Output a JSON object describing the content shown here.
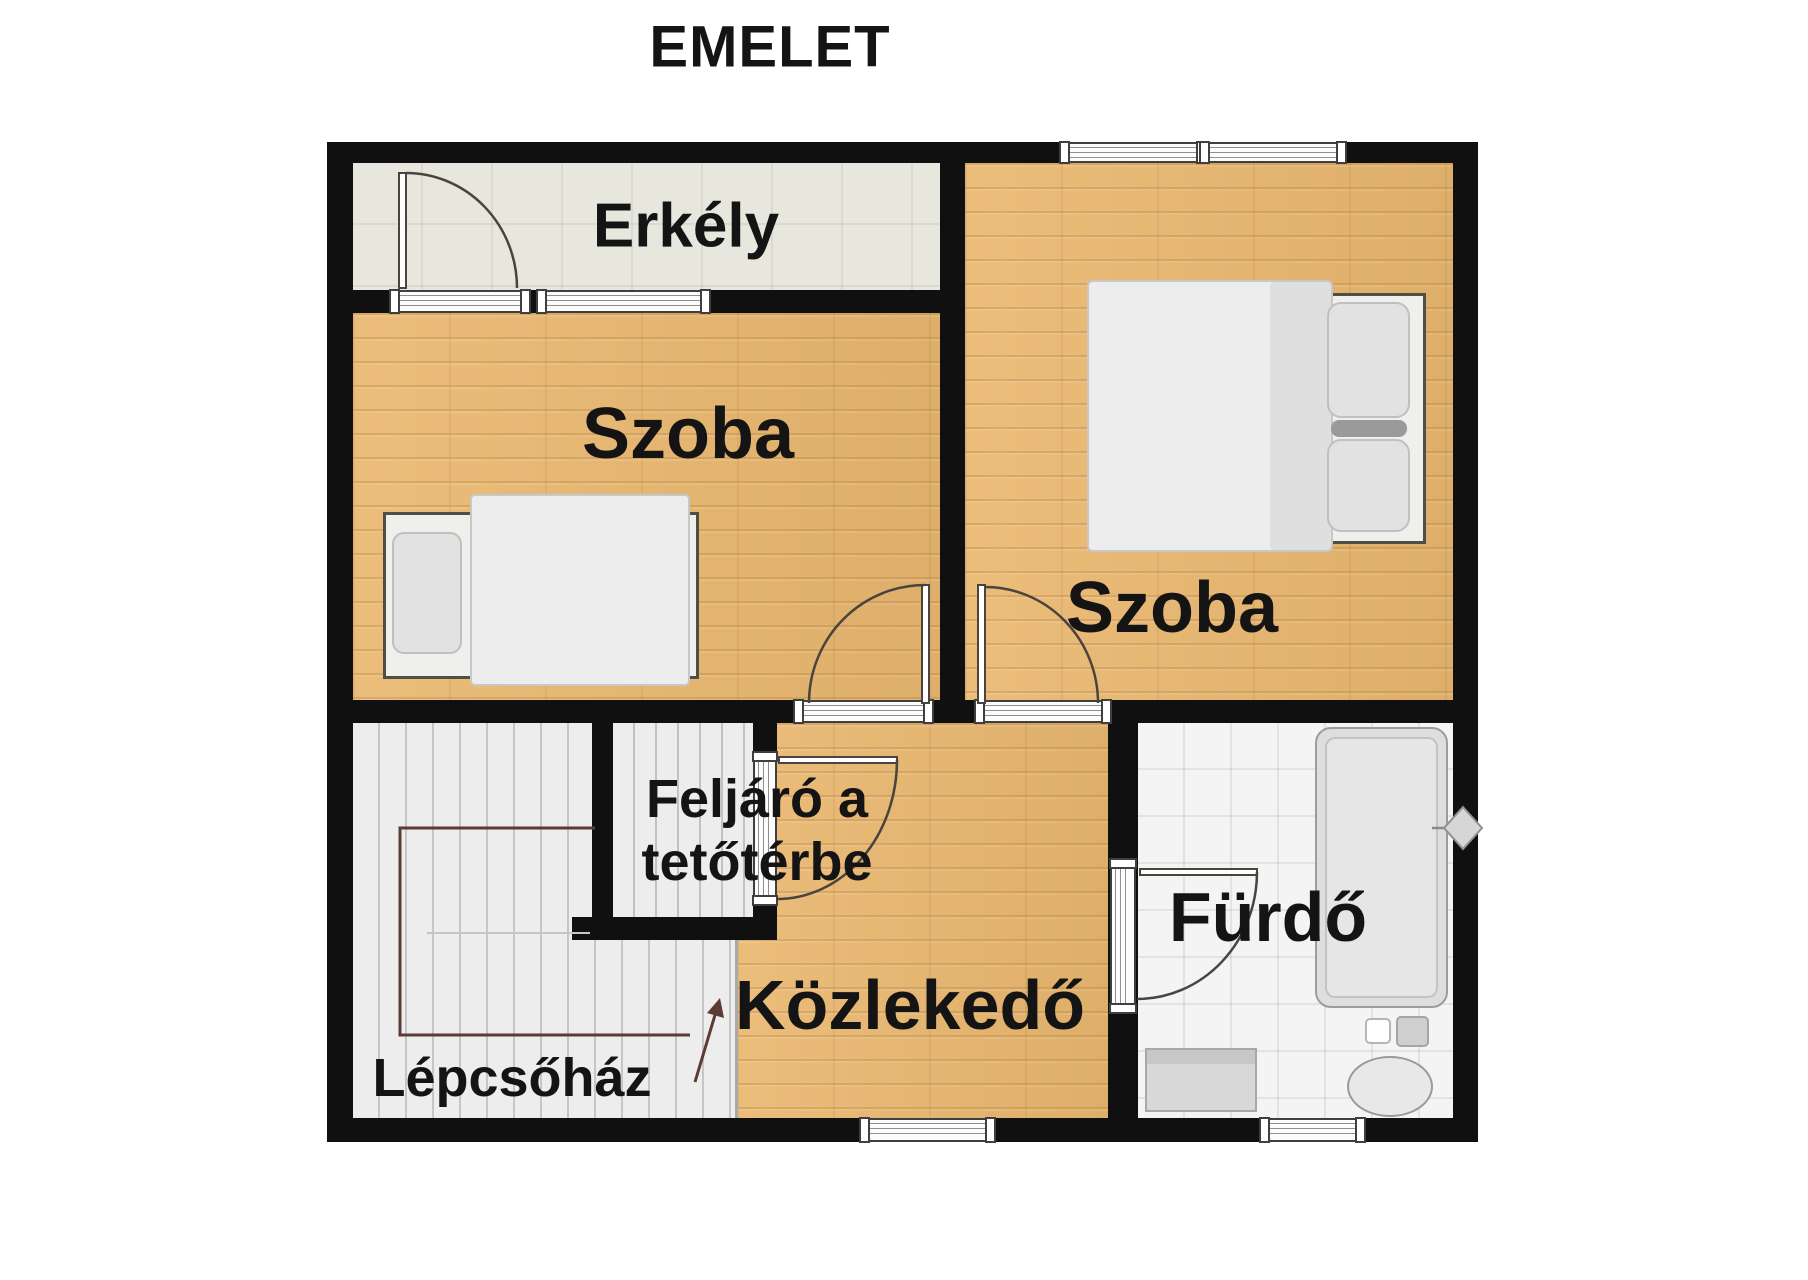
{
  "title": "EMELET",
  "rooms": {
    "balcony": {
      "label": "Erkély"
    },
    "bedroom_left": {
      "label": "Szoba"
    },
    "bedroom_right": {
      "label": "Szoba"
    },
    "attic_access": {
      "label_line1": "Feljáró a",
      "label_line2": "tetőtérbe"
    },
    "hallway": {
      "label": "Közlekedő"
    },
    "bathroom": {
      "label": "Fürdő"
    },
    "staircase": {
      "label": "Lépcsőház"
    }
  },
  "colors": {
    "wall": "#101010",
    "wood_floor": "#eab870",
    "balcony_floor": "#e8e7dd",
    "stair_floor": "#ededed",
    "tile_floor": "#f4f4f4",
    "label_text": "#141414",
    "door_swing": "#4a443e",
    "stair_rail": "#5d3b33",
    "fixture_fill": "#dcdcdc",
    "bedding": "#ededed"
  },
  "icons": {
    "window": "striped-band",
    "door-swing": "quarter-arc",
    "single-bed": "css-shape",
    "double-bed": "css-shape",
    "bathtub": "css-shape",
    "sink": "css-shape",
    "toilet": "css-shape",
    "shower-mixer": "diamond",
    "stairs-direction-arrow": "polyline-arrow",
    "attic-stairs": "striped-treads"
  }
}
